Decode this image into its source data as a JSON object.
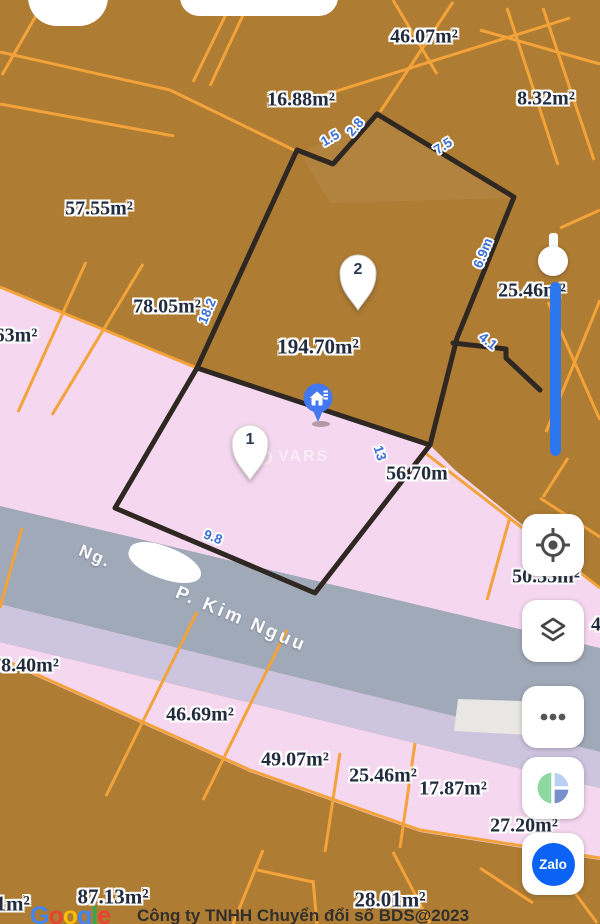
{
  "map": {
    "area_labels": [
      {
        "t": "46.07m²",
        "x": 424,
        "y": 37,
        "s": 20
      },
      {
        "t": "16.88m²",
        "x": 301,
        "y": 100,
        "s": 20
      },
      {
        "t": "8.32m²",
        "x": 546,
        "y": 99,
        "s": 20
      },
      {
        "t": "57.55m²",
        "x": 99,
        "y": 209,
        "s": 20
      },
      {
        "t": "78.05m²",
        "x": 167,
        "y": 307,
        "s": 20
      },
      {
        "t": "63m²",
        "x": 16,
        "y": 336,
        "s": 20
      },
      {
        "t": "194.70m²",
        "x": 318,
        "y": 347,
        "s": 21
      },
      {
        "t": "25.46m²",
        "x": 532,
        "y": 291,
        "s": 20
      },
      {
        "t": "56.70m",
        "x": 417,
        "y": 474,
        "s": 20
      },
      {
        "t": "50.33m²",
        "x": 546,
        "y": 577,
        "s": 20
      },
      {
        "t": "78.40m²",
        "x": 25,
        "y": 666,
        "s": 20
      },
      {
        "t": "46.69m²",
        "x": 200,
        "y": 715,
        "s": 20
      },
      {
        "t": "49.07m²",
        "x": 295,
        "y": 760,
        "s": 20
      },
      {
        "t": "25.46m²",
        "x": 383,
        "y": 776,
        "s": 20
      },
      {
        "t": "17.87m²",
        "x": 453,
        "y": 789,
        "s": 20
      },
      {
        "t": "27.20m²",
        "x": 524,
        "y": 826,
        "s": 20
      },
      {
        "t": "87.13m²",
        "x": 113,
        "y": 897,
        "s": 21
      },
      {
        "t": "28.01m²",
        "x": 390,
        "y": 900,
        "s": 21
      },
      {
        "t": "11m²",
        "x": 8,
        "y": 904,
        "s": 21
      },
      {
        "t": "46",
        "x": 601,
        "y": 625,
        "s": 20
      }
    ],
    "dim_labels": [
      {
        "t": "1.5",
        "x": 330,
        "y": 138,
        "r": -30
      },
      {
        "t": "2.8",
        "x": 355,
        "y": 127,
        "r": -50
      },
      {
        "t": "7.5",
        "x": 443,
        "y": 146,
        "r": -33
      },
      {
        "t": "6.9m",
        "x": 483,
        "y": 253,
        "r": -68
      },
      {
        "t": "4.1",
        "x": 488,
        "y": 341,
        "r": 38
      },
      {
        "t": "18.2",
        "x": 207,
        "y": 311,
        "r": -67
      },
      {
        "t": "13",
        "x": 380,
        "y": 453,
        "r": 72
      },
      {
        "t": "9.8",
        "x": 213,
        "y": 537,
        "r": 21
      }
    ],
    "street": {
      "prefix": "Ng.",
      "name": "P. Kim Nguu"
    },
    "watermark": "VARS"
  },
  "markers": {
    "pin1": "1",
    "pin2": "2"
  },
  "controls": {
    "zalo": "Zalo"
  },
  "attribution": {
    "brand_letters": [
      "G",
      "o",
      "o",
      "g",
      "l",
      "e"
    ],
    "copyright": "Công ty TNHH Chuyển đổi số BDS@2023"
  },
  "colors": {
    "parcel_brown": "#ae7c33",
    "parcel_pink": "#f6d7f0",
    "lavender_band": "#cdc4e0",
    "road_gray": "#a0a9b8",
    "cadastral_orange": "#f3a33a",
    "boundary_black": "#2f2822",
    "dimension_blue": "#3a6fd6",
    "slider_blue": "#2d77ee",
    "house_marker_blue": "#4478f0",
    "zalo_blue": "#0a63f5"
  }
}
